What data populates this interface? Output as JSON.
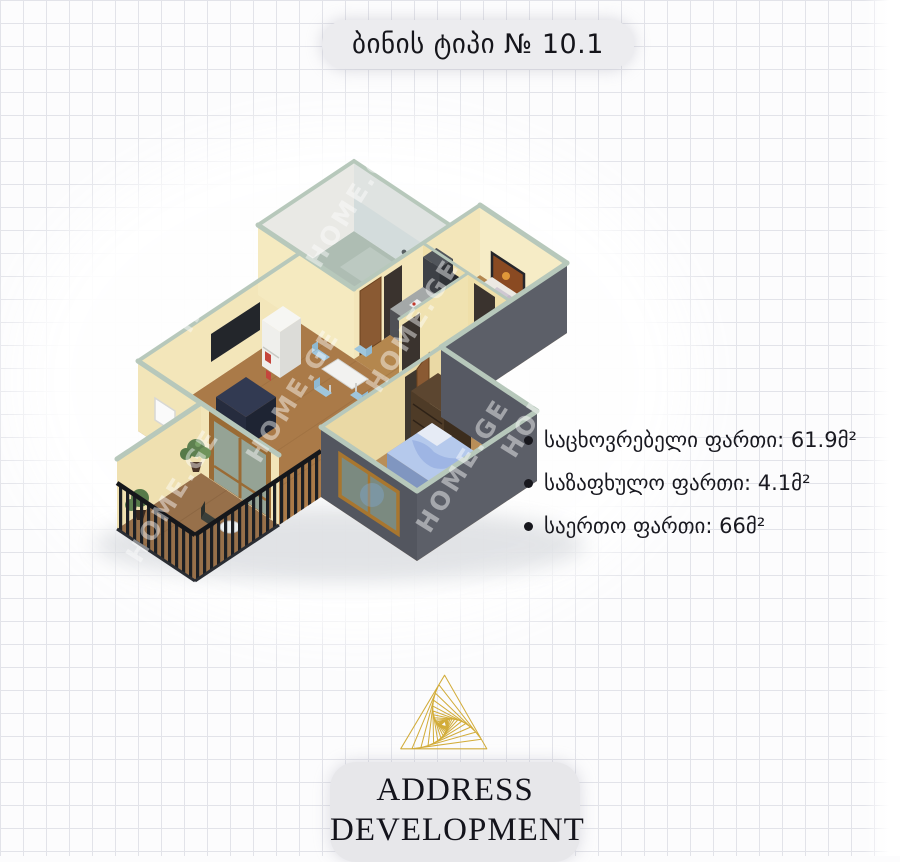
{
  "page": {
    "background_color": "#fcfcfd",
    "grid_color": "#e2e3e9",
    "grid_size_px": 23
  },
  "header": {
    "title": "ბინის ტიპი № 10.1"
  },
  "floorplan": {
    "watermark": "HOME.GE",
    "palette": {
      "wall_cream": "#f3e6ba",
      "wall_shaded": "#e9d8a6",
      "wall_top": "#b7c8bb",
      "exterior_dark": "#5c5f68",
      "floor_wood": "#ab7c4c",
      "bathroom_tile": "#aebdb3",
      "railing": "#1c1f24",
      "glass": "#8fa096",
      "bed_blue": "#9db4e4"
    }
  },
  "specs": {
    "items": [
      {
        "text": "საცხოვრებელი ფართი: 61.9მ²"
      },
      {
        "text": "საზაფხულო ფართი: 4.1მ²"
      },
      {
        "text": "საერთო ფართი: 66მ²"
      }
    ]
  },
  "logo": {
    "line1": "ADDRESS",
    "line2": "DEVELOPMENT",
    "triangle_color": "#d2ac39"
  }
}
